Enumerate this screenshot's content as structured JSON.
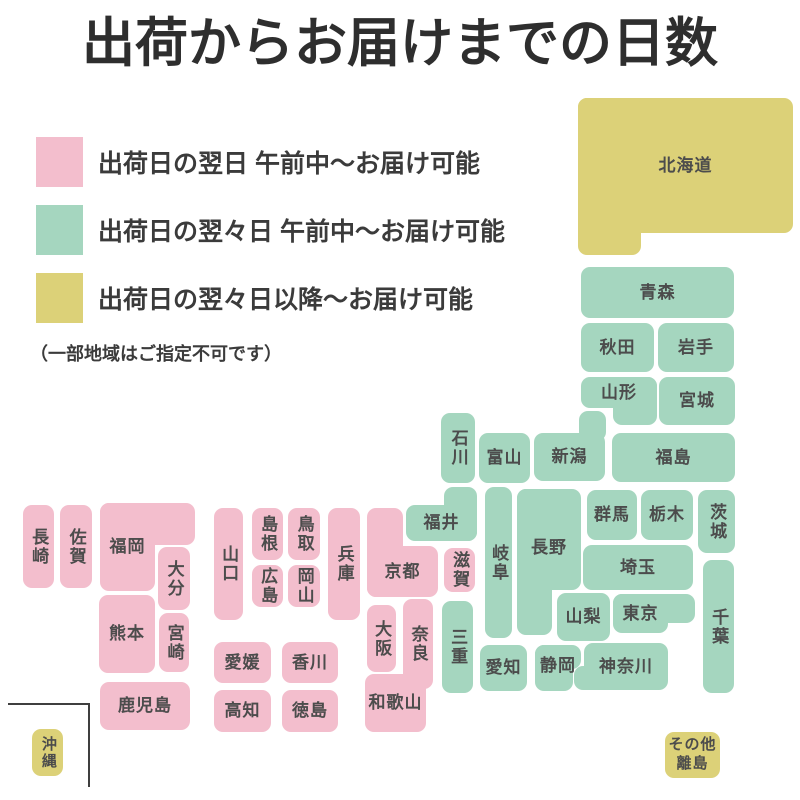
{
  "title": "出荷からお届けまでの日数",
  "colors": {
    "next_day": "#F3BECD",
    "two_days": "#A5D6BF",
    "three_plus": "#DCD178",
    "tile_text": "#4C4C4C",
    "title_text": "#2E2E2E",
    "inset_line": "#3F3F3F"
  },
  "legend": {
    "items": [
      {
        "color": "next_day",
        "label": "出荷日の翌日 午前中〜お届け可能"
      },
      {
        "color": "two_days",
        "label": "出荷日の翌々日 午前中〜お届け可能"
      },
      {
        "color": "three_plus",
        "label": "出荷日の翌々日以降〜お届け可能"
      }
    ],
    "note": "（一部地域はご指定不可です）"
  },
  "map": {
    "regions": [
      {
        "name": "hokkaido",
        "label": "北海道",
        "color": "three_plus",
        "rects": [
          [
            578,
            98,
            215,
            135
          ],
          [
            578,
            98,
            63,
            157
          ]
        ]
      },
      {
        "name": "aomori",
        "label": "青森",
        "color": "two_days",
        "rects": [
          [
            581,
            267,
            153,
            51
          ]
        ]
      },
      {
        "name": "akita",
        "label": "秋田",
        "color": "two_days",
        "rects": [
          [
            581,
            323,
            73,
            49
          ]
        ]
      },
      {
        "name": "iwate",
        "label": "岩手",
        "color": "two_days",
        "rects": [
          [
            658,
            323,
            76,
            49
          ]
        ]
      },
      {
        "name": "yamagata",
        "label": "山形",
        "color": "two_days",
        "rects": [
          [
            581,
            377,
            76,
            31
          ],
          [
            613,
            377,
            44,
            48
          ]
        ]
      },
      {
        "name": "miyagi",
        "label": "宮城",
        "color": "two_days",
        "rects": [
          [
            659,
            377,
            76,
            48
          ]
        ]
      },
      {
        "name": "niigata",
        "label": "新潟",
        "color": "two_days",
        "rects": [
          [
            534,
            433,
            71,
            48
          ],
          [
            579,
            411,
            27,
            30
          ]
        ]
      },
      {
        "name": "fukushima",
        "label": "福島",
        "color": "two_days",
        "rects": [
          [
            612,
            433,
            123,
            49
          ]
        ]
      },
      {
        "name": "ishikawa",
        "label": "石川",
        "color": "two_days",
        "vertical": true,
        "rects": [
          [
            441,
            413,
            34,
            70
          ]
        ]
      },
      {
        "name": "toyama",
        "label": "富山",
        "color": "two_days",
        "rects": [
          [
            479,
            433,
            51,
            50
          ]
        ]
      },
      {
        "name": "gunma",
        "label": "群馬",
        "color": "two_days",
        "rects": [
          [
            587,
            490,
            50,
            50
          ]
        ]
      },
      {
        "name": "tochigi",
        "label": "栃木",
        "color": "two_days",
        "rects": [
          [
            641,
            490,
            52,
            50
          ]
        ]
      },
      {
        "name": "ibaraki",
        "label": "茨城",
        "color": "two_days",
        "vertical": true,
        "rects": [
          [
            698,
            490,
            37,
            63
          ]
        ]
      },
      {
        "name": "saitama",
        "label": "埼玉",
        "color": "two_days",
        "rects": [
          [
            583,
            545,
            110,
            45
          ]
        ]
      },
      {
        "name": "chiba",
        "label": "千葉",
        "color": "two_days",
        "vertical": true,
        "rects": [
          [
            703,
            560,
            31,
            133
          ]
        ]
      },
      {
        "name": "tokyo",
        "label": "東京",
        "color": "two_days",
        "rects": [
          [
            613,
            594,
            55,
            39
          ],
          [
            613,
            594,
            82,
            29
          ]
        ]
      },
      {
        "name": "yamanashi",
        "label": "山梨",
        "color": "two_days",
        "rects": [
          [
            557,
            593,
            53,
            48
          ]
        ]
      },
      {
        "name": "nagano",
        "label": "長野",
        "color": "two_days",
        "rects": [
          [
            517,
            489,
            64,
            101
          ],
          [
            517,
            489,
            35,
            146
          ]
        ],
        "lbox": [
          517,
          489,
          64,
          118
        ]
      },
      {
        "name": "gifu",
        "label": "岐阜",
        "color": "two_days",
        "vertical": true,
        "rects": [
          [
            485,
            487,
            27,
            151
          ]
        ]
      },
      {
        "name": "fukui",
        "label": "福井",
        "color": "two_days",
        "rects": [
          [
            406,
            505,
            71,
            36
          ],
          [
            444,
            487,
            33,
            54
          ]
        ]
      },
      {
        "name": "shiga",
        "label": "滋賀",
        "color": "next_day",
        "vertical": true,
        "rects": [
          [
            444,
            548,
            31,
            44
          ]
        ]
      },
      {
        "name": "mie",
        "label": "三重",
        "color": "two_days",
        "vertical": true,
        "rects": [
          [
            442,
            601,
            31,
            92
          ]
        ]
      },
      {
        "name": "aichi",
        "label": "愛知",
        "color": "two_days",
        "rects": [
          [
            480,
            645,
            47,
            46
          ]
        ]
      },
      {
        "name": "shizuoka",
        "label": "静岡",
        "color": "two_days",
        "rects": [
          [
            535,
            645,
            46,
            24
          ],
          [
            535,
            645,
            38,
            46
          ]
        ],
        "lbox": [
          535,
          645,
          46,
          42
        ]
      },
      {
        "name": "kanagawa",
        "label": "神奈川",
        "color": "two_days",
        "rects": [
          [
            584,
            643,
            84,
            47
          ],
          [
            574,
            666,
            30,
            24
          ]
        ]
      },
      {
        "name": "kyoto",
        "label": "京都",
        "color": "next_day",
        "rects": [
          [
            367,
            546,
            71,
            51
          ],
          [
            367,
            508,
            36,
            89
          ]
        ]
      },
      {
        "name": "osaka",
        "label": "大阪",
        "color": "next_day",
        "vertical": true,
        "rects": [
          [
            367,
            605,
            29,
            67
          ]
        ]
      },
      {
        "name": "nara",
        "label": "奈良",
        "color": "next_day",
        "vertical": true,
        "rects": [
          [
            403,
            599,
            30,
            90
          ]
        ]
      },
      {
        "name": "wakayama",
        "label": "和歌山",
        "color": "next_day",
        "rects": [
          [
            365,
            674,
            61,
            58
          ]
        ]
      },
      {
        "name": "hyogo",
        "label": "兵庫",
        "color": "next_day",
        "vertical": true,
        "rects": [
          [
            328,
            508,
            32,
            112
          ]
        ]
      },
      {
        "name": "tottori",
        "label": "鳥取",
        "color": "next_day",
        "vertical": true,
        "rects": [
          [
            288,
            508,
            32,
            52
          ]
        ]
      },
      {
        "name": "okayama",
        "label": "岡山",
        "color": "next_day",
        "vertical": true,
        "rects": [
          [
            288,
            565,
            32,
            42
          ]
        ]
      },
      {
        "name": "shimane",
        "label": "島根",
        "color": "next_day",
        "vertical": true,
        "rects": [
          [
            252,
            508,
            31,
            52
          ]
        ]
      },
      {
        "name": "hiroshima",
        "label": "広島",
        "color": "next_day",
        "vertical": true,
        "rects": [
          [
            252,
            565,
            31,
            42
          ]
        ]
      },
      {
        "name": "yamaguchi",
        "label": "山口",
        "color": "next_day",
        "vertical": true,
        "rects": [
          [
            214,
            508,
            29,
            112
          ]
        ]
      },
      {
        "name": "ehime",
        "label": "愛媛",
        "color": "next_day",
        "rects": [
          [
            214,
            642,
            57,
            41
          ]
        ]
      },
      {
        "name": "kagawa",
        "label": "香川",
        "color": "next_day",
        "rects": [
          [
            282,
            642,
            56,
            41
          ]
        ]
      },
      {
        "name": "kochi",
        "label": "高知",
        "color": "next_day",
        "rects": [
          [
            214,
            690,
            57,
            42
          ]
        ]
      },
      {
        "name": "tokushima",
        "label": "徳島",
        "color": "next_day",
        "rects": [
          [
            282,
            690,
            56,
            42
          ]
        ]
      },
      {
        "name": "fukuoka",
        "label": "福岡",
        "color": "next_day",
        "rects": [
          [
            100,
            503,
            55,
            88
          ],
          [
            100,
            503,
            95,
            42
          ]
        ]
      },
      {
        "name": "saga",
        "label": "佐賀",
        "color": "next_day",
        "vertical": true,
        "rects": [
          [
            60,
            505,
            32,
            83
          ]
        ]
      },
      {
        "name": "nagasaki",
        "label": "長崎",
        "color": "next_day",
        "vertical": true,
        "rects": [
          [
            23,
            505,
            31,
            83
          ]
        ]
      },
      {
        "name": "oita",
        "label": "大分",
        "color": "next_day",
        "vertical": true,
        "rects": [
          [
            158,
            547,
            32,
            63
          ]
        ]
      },
      {
        "name": "kumamoto",
        "label": "熊本",
        "color": "next_day",
        "rects": [
          [
            99,
            595,
            56,
            78
          ]
        ]
      },
      {
        "name": "miyazaki",
        "label": "宮崎",
        "color": "next_day",
        "vertical": true,
        "rects": [
          [
            159,
            613,
            30,
            59
          ]
        ]
      },
      {
        "name": "kagoshima",
        "label": "鹿児島",
        "color": "next_day",
        "rects": [
          [
            100,
            682,
            90,
            48
          ]
        ]
      },
      {
        "name": "okinawa",
        "label": "沖縄",
        "color": "three_plus",
        "vertical": true,
        "font": 15,
        "rects": [
          [
            32,
            729,
            31,
            47
          ]
        ]
      },
      {
        "name": "other-islands",
        "label": "その他\n離島",
        "color": "three_plus",
        "font": 15,
        "rects": [
          [
            665,
            732,
            55,
            46
          ]
        ]
      }
    ]
  }
}
